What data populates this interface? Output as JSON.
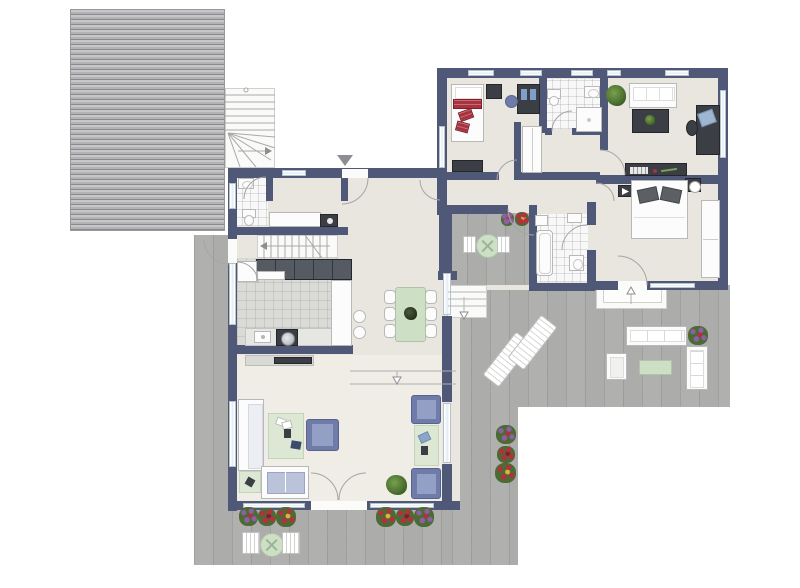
{
  "palette": {
    "wall": "#4f5977",
    "floor": "#e9e6e0",
    "floor_living": "#f0ede7",
    "tile_kitchen": "#dadad6",
    "tile_bath": "#f8f8f8",
    "paving": "#acacaa",
    "roof_light": "#c7c7c9",
    "roof_mid": "#b3b3b5",
    "roof_dark": "#8a8a8e",
    "white_furn": "#fcfcfc",
    "furn_border": "#b8b8b8",
    "blue": "#6f7ca9",
    "blue_light": "#939fc5",
    "blue_border": "#59648c",
    "rug_green": "#dce8d4",
    "table_green": "#cde0c6",
    "dark": "#3b3e44",
    "red": "#a63440",
    "glass": "#e3edf4",
    "line": "#a2a2a2",
    "plant_dark": "#3f6428",
    "plant_light": "#79a04f",
    "flower_purple": "#8c5fa6",
    "flower_red": "#b5303e",
    "flower_yellow": "#d6b83a",
    "steel": "#c0c4c8"
  },
  "markers": {
    "entrance_marker": "triangle-down",
    "stair_direction": "arrow",
    "floor_level_change": "arrow-down-outline",
    "terrace_entry": "arrow-up-outline"
  },
  "legend_rooms": [
    "carport-roof",
    "exterior-winder-stair",
    "bedroom",
    "bathroom",
    "corridor",
    "study",
    "master-bedroom",
    "ensuite-bathroom",
    "inner-courtyard",
    "wc",
    "hallway",
    "staircase",
    "kitchen",
    "dining-area",
    "living-room",
    "terrace",
    "garden-path"
  ]
}
